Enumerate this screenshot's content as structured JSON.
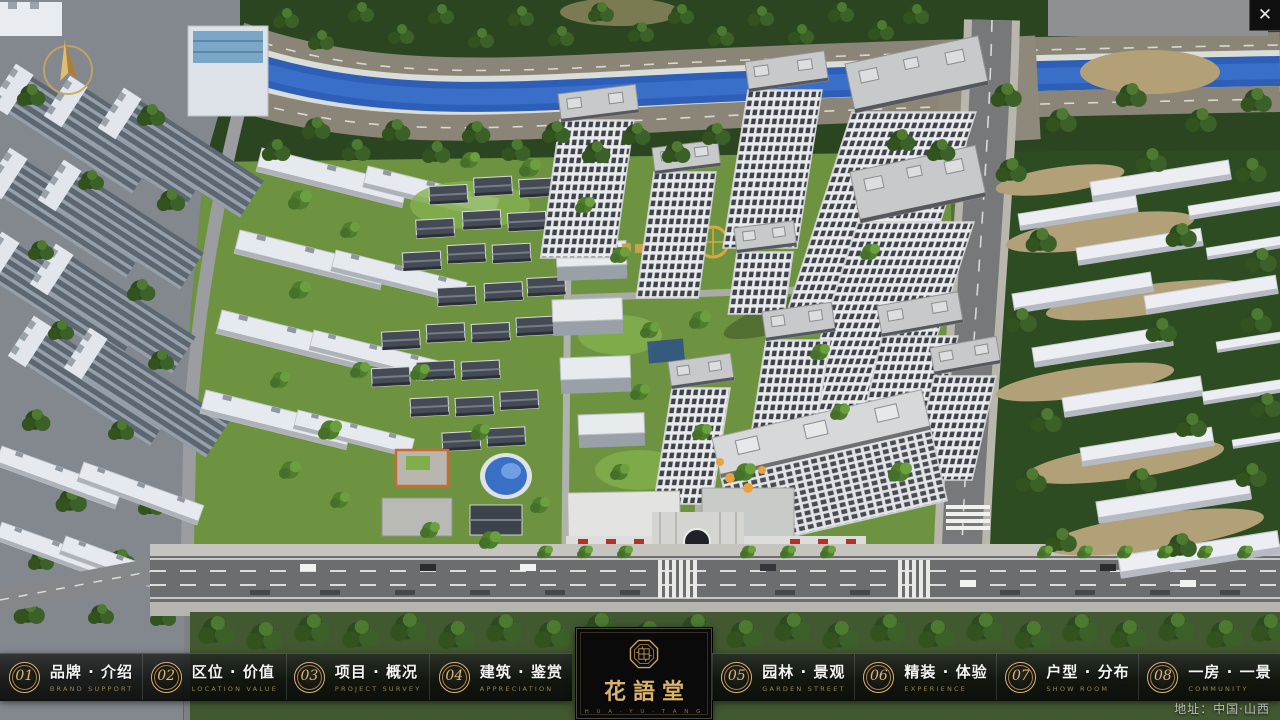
{
  "scene": {
    "description": "aerial 3D masterplan render of residential community",
    "address_label": "地址：中国·山西",
    "close_glyph": "✕"
  },
  "logo": {
    "name": "花語堂",
    "caption": "H U A · Y U · T A N G"
  },
  "nav": {
    "items": [
      {
        "num": "01",
        "title": "品牌 · 介绍",
        "subtitle": "BRAND SUPPORT"
      },
      {
        "num": "02",
        "title": "区位 · 价值",
        "subtitle": "LOCATION VALUE"
      },
      {
        "num": "03",
        "title": "项目 · 概况",
        "subtitle": "PROJECT SURVEY"
      },
      {
        "num": "04",
        "title": "建筑 · 鉴赏",
        "subtitle": "APPRECIATION"
      },
      {
        "num": "05",
        "title": "园林 · 景观",
        "subtitle": "GARDEN STREET"
      },
      {
        "num": "06",
        "title": "精装 · 体验",
        "subtitle": "EXPERIENCE"
      },
      {
        "num": "07",
        "title": "户型 · 分布",
        "subtitle": "SHOW ROOM"
      },
      {
        "num": "08",
        "title": "一房 · 一景",
        "subtitle": "COMMUNITY"
      }
    ]
  },
  "colors": {
    "gold": "#c9a45f",
    "bar_bg": "rgba(10,12,10,0.86)",
    "river": "#2d5fb8",
    "lawn": "#6e9340"
  }
}
